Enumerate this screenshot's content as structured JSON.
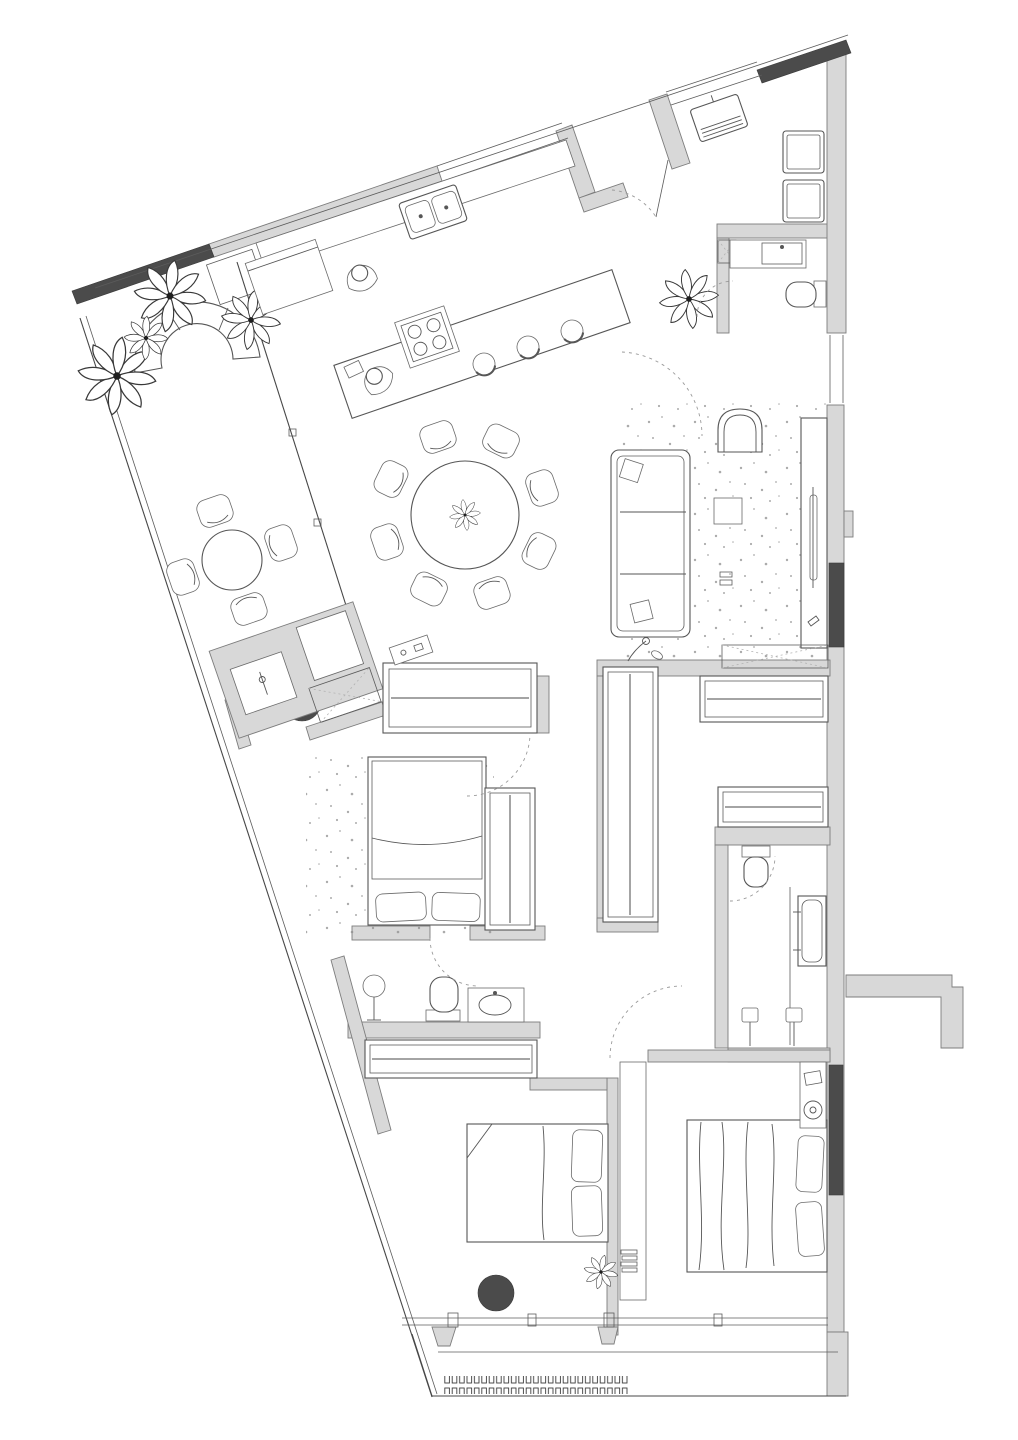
{
  "document": {
    "type": "architectural floor plan",
    "title": "apartment-floor-plan",
    "drawing_style": "top-down 2D line drawing, hand-sketched furniture, no dimension text",
    "visible_text": "none",
    "orientation": "upper wall band slanted about -19 degrees; unit tapers toward lower-left"
  },
  "colors": {
    "background": "#ffffff",
    "wall_light": "#d8d8d8",
    "wall_dark": "#4b4b4b",
    "line": "#474747",
    "furniture_line": "#565656",
    "dashed_line": "#9b9b9b",
    "rug_speckle": "#8f8f8f",
    "column_fill": "#4b4b4b"
  },
  "summary": {
    "structural_columns": 2,
    "door_swing_arcs": 7,
    "wardrobe_units": 6,
    "beds": 3,
    "toilets": 3,
    "plants": 7,
    "bathrooms": 3,
    "balconies": 2
  },
  "rooms": [
    {
      "id": "terrace",
      "label": "terrace",
      "items": [
        "dark-planter-bar",
        "monstera-plants",
        "curved-outdoor-sofa",
        "round-table",
        "four-chairs",
        "bbq-counter-with-tap",
        "structural-column"
      ]
    },
    {
      "id": "kitchen",
      "label": "kitchen",
      "items": [
        "wall-counter",
        "double-sink",
        "tall-cabinet",
        "island",
        "gas-hob",
        "three-bar-stools",
        "standing-person",
        "seated-person"
      ]
    },
    {
      "id": "dining",
      "label": "dining area",
      "items": [
        "round-table",
        "eight-chairs",
        "centerpiece-plant"
      ]
    },
    {
      "id": "living",
      "label": "living room",
      "items": [
        "speckled-rug",
        "three-seat-sofa",
        "two-throw-pillows",
        "armchair",
        "side-table",
        "tv-sideboard",
        "tv",
        "floor-lamp"
      ]
    },
    {
      "id": "entry",
      "label": "entry hall",
      "items": [
        "vestibule-walls",
        "entry-door-swing",
        "wall-console",
        "plant",
        "stacked-washer-dryer"
      ]
    },
    {
      "id": "powder",
      "label": "powder room",
      "items": [
        "vanity-sink",
        "toilet",
        "service-shaft",
        "door-swing"
      ]
    },
    {
      "id": "hallway",
      "label": "hallway",
      "items": [
        "wardrobe-with-hangers",
        "sliding-hatch-threshold",
        "switch-panel"
      ]
    },
    {
      "id": "closet",
      "label": "walk-in closet",
      "items": [
        "vertical-hanging-rail",
        "two-horizontal-hanging-rails"
      ]
    },
    {
      "id": "master",
      "label": "bedroom 1",
      "items": [
        "speckled-rug",
        "double-bed",
        "two-pillows",
        "wardrobe-with-hangers",
        "door-swing"
      ]
    },
    {
      "id": "midbath",
      "label": "bathroom 2",
      "items": [
        "shower-head-on-stand",
        "toilet",
        "vanity-basin",
        "wardrobe-with-hangers",
        "door-swing"
      ]
    },
    {
      "id": "bedroom2",
      "label": "bedroom 2",
      "items": [
        "double-bed",
        "two-pillows",
        "headboard-partition",
        "shelf-unit",
        "books",
        "plant",
        "structural-column"
      ]
    },
    {
      "id": "bedroom3",
      "label": "bedroom 3",
      "items": [
        "double-bed",
        "two-pillows",
        "nightstand",
        "table-lamp"
      ]
    },
    {
      "id": "mainbath",
      "label": "main bathroom",
      "items": [
        "toilet",
        "bathtub",
        "two-shower-heads",
        "door-swing"
      ]
    },
    {
      "id": "balcony",
      "label": "lower balcony",
      "items": [
        "window-wall",
        "decking-strip",
        "mullion-brackets"
      ]
    }
  ]
}
